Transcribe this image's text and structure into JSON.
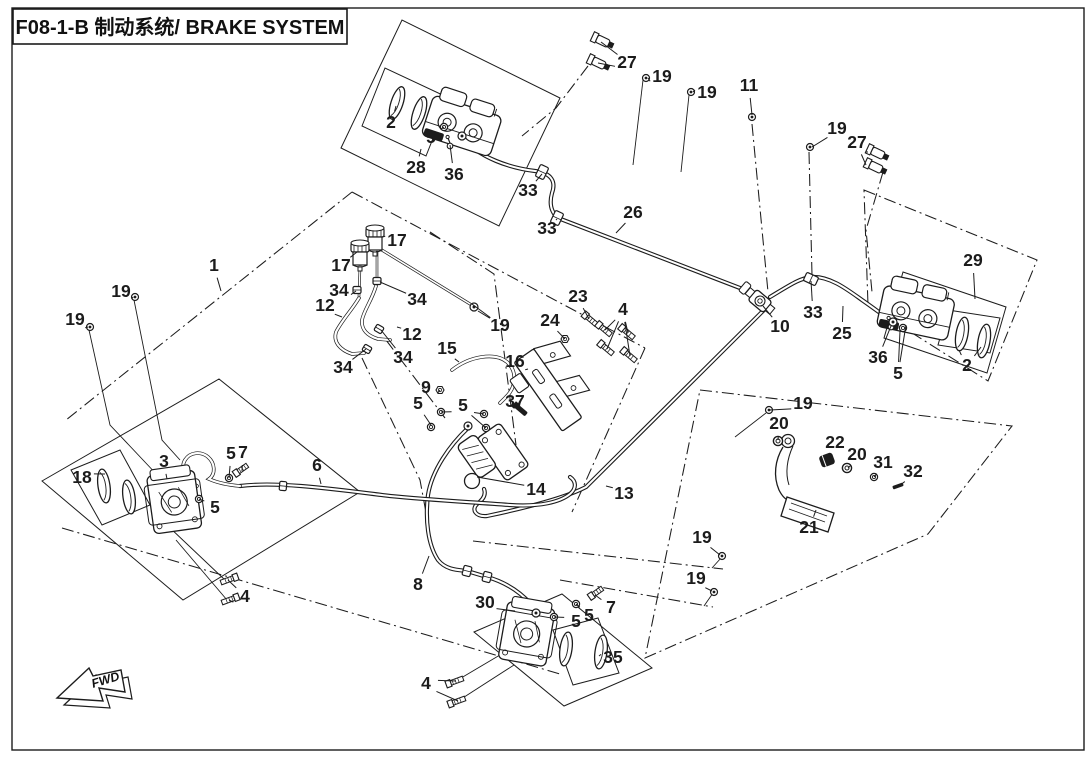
{
  "title": {
    "full": "F08-1-B 制动系统/ BRAKE SYSTEM"
  },
  "direction_arrow": {
    "label": "FWD"
  },
  "colors": {
    "ink": "#1c1c1c",
    "paper": "#ffffff"
  },
  "callouts": [
    {
      "n": "1",
      "x": 214,
      "y": 265,
      "targets": [
        [
          221,
          291
        ]
      ]
    },
    {
      "n": "2",
      "x": 391,
      "y": 122,
      "targets": [
        [
          396,
          106
        ]
      ]
    },
    {
      "n": "2",
      "x": 967,
      "y": 365,
      "targets": [
        [
          959,
          350
        ],
        [
          981,
          347
        ]
      ]
    },
    {
      "n": "3",
      "x": 164,
      "y": 461,
      "targets": [
        [
          167,
          479
        ]
      ]
    },
    {
      "n": "4",
      "x": 623,
      "y": 309,
      "targets": [
        [
          605,
          330
        ],
        [
          628,
          333
        ],
        [
          607,
          349
        ],
        [
          630,
          356
        ]
      ]
    },
    {
      "n": "4",
      "x": 245,
      "y": 596,
      "targets": [
        [
          228,
          580
        ],
        [
          229,
          600
        ]
      ]
    },
    {
      "n": "4",
      "x": 426,
      "y": 683,
      "targets": [
        [
          456,
          681
        ],
        [
          458,
          701
        ]
      ]
    },
    {
      "n": "5",
      "x": 431,
      "y": 137,
      "targets": [
        [
          444,
          127
        ]
      ]
    },
    {
      "n": "5",
      "x": 898,
      "y": 373,
      "targets": [
        [
          900,
          331
        ],
        [
          906,
          325
        ]
      ]
    },
    {
      "n": "5",
      "x": 418,
      "y": 403,
      "targets": [
        [
          431,
          425
        ]
      ]
    },
    {
      "n": "5",
      "x": 463,
      "y": 405,
      "targets": [
        [
          441,
          412
        ],
        [
          484,
          414
        ],
        [
          486,
          428
        ]
      ]
    },
    {
      "n": "5",
      "x": 231,
      "y": 453,
      "targets": [
        [
          229,
          478
        ]
      ]
    },
    {
      "n": "5",
      "x": 215,
      "y": 507,
      "targets": [
        [
          199,
          499
        ]
      ]
    },
    {
      "n": "5",
      "x": 576,
      "y": 621,
      "targets": [
        [
          554,
          617
        ]
      ]
    },
    {
      "n": "5",
      "x": 589,
      "y": 615,
      "targets": [
        [
          576,
          604
        ]
      ]
    },
    {
      "n": "6",
      "x": 317,
      "y": 465,
      "targets": [
        [
          321,
          484
        ]
      ]
    },
    {
      "n": "7",
      "x": 243,
      "y": 452,
      "targets": [
        [
          242,
          471
        ]
      ]
    },
    {
      "n": "7",
      "x": 611,
      "y": 607,
      "targets": [
        [
          595,
          595
        ]
      ]
    },
    {
      "n": "8",
      "x": 418,
      "y": 584,
      "targets": [
        [
          429,
          556
        ]
      ]
    },
    {
      "n": "9",
      "x": 426,
      "y": 387,
      "targets": [
        [
          440,
          390
        ]
      ]
    },
    {
      "n": "10",
      "x": 780,
      "y": 326,
      "targets": [
        [
          763,
          306
        ]
      ]
    },
    {
      "n": "11",
      "x": 749,
      "y": 85,
      "targets": [
        [
          752,
          115
        ]
      ]
    },
    {
      "n": "12",
      "x": 325,
      "y": 305,
      "targets": [
        [
          342,
          317
        ]
      ]
    },
    {
      "n": "12",
      "x": 412,
      "y": 334,
      "targets": [
        [
          397,
          327
        ]
      ]
    },
    {
      "n": "13",
      "x": 624,
      "y": 493,
      "targets": [
        [
          606,
          486
        ]
      ]
    },
    {
      "n": "14",
      "x": 536,
      "y": 489,
      "targets": [
        [
          477,
          477
        ]
      ]
    },
    {
      "n": "15",
      "x": 447,
      "y": 348,
      "targets": [
        [
          459,
          362
        ]
      ]
    },
    {
      "n": "16",
      "x": 515,
      "y": 361,
      "targets": [
        [
          528,
          369
        ]
      ]
    },
    {
      "n": "17",
      "x": 397,
      "y": 240,
      "targets": [
        [
          382,
          237
        ]
      ]
    },
    {
      "n": "17",
      "x": 341,
      "y": 265,
      "targets": [
        [
          357,
          252
        ]
      ]
    },
    {
      "n": "18",
      "x": 82,
      "y": 477,
      "targets": [
        [
          105,
          474
        ]
      ]
    },
    {
      "n": "19",
      "x": 662,
      "y": 76,
      "targets": [
        [
          648,
          78
        ]
      ]
    },
    {
      "n": "19",
      "x": 707,
      "y": 92,
      "targets": [
        [
          693,
          92
        ]
      ]
    },
    {
      "n": "19",
      "x": 837,
      "y": 128,
      "targets": [
        [
          812,
          147
        ]
      ]
    },
    {
      "n": "19",
      "x": 121,
      "y": 291,
      "targets": [
        [
          133,
          297
        ]
      ]
    },
    {
      "n": "19",
      "x": 75,
      "y": 319,
      "targets": [
        [
          88,
          327
        ]
      ]
    },
    {
      "n": "19",
      "x": 500,
      "y": 325,
      "targets": [
        [
          472,
          304
        ],
        [
          478,
          311
        ]
      ]
    },
    {
      "n": "19",
      "x": 803,
      "y": 403,
      "targets": [
        [
          770,
          410
        ]
      ]
    },
    {
      "n": "19",
      "x": 702,
      "y": 537,
      "targets": [
        [
          720,
          555
        ]
      ]
    },
    {
      "n": "19",
      "x": 696,
      "y": 578,
      "targets": [
        [
          712,
          591
        ]
      ]
    },
    {
      "n": "20",
      "x": 779,
      "y": 423,
      "targets": [
        [
          778,
          440
        ]
      ]
    },
    {
      "n": "20",
      "x": 857,
      "y": 454,
      "targets": [
        [
          848,
          468
        ]
      ]
    },
    {
      "n": "21",
      "x": 809,
      "y": 527,
      "targets": [
        [
          816,
          510
        ]
      ]
    },
    {
      "n": "22",
      "x": 835,
      "y": 442,
      "targets": [
        [
          828,
          459
        ]
      ]
    },
    {
      "n": "23",
      "x": 578,
      "y": 296,
      "targets": [
        [
          589,
          319
        ]
      ]
    },
    {
      "n": "24",
      "x": 550,
      "y": 320,
      "targets": [
        [
          565,
          339
        ]
      ]
    },
    {
      "n": "25",
      "x": 842,
      "y": 333,
      "targets": [
        [
          843,
          306
        ]
      ]
    },
    {
      "n": "26",
      "x": 633,
      "y": 212,
      "targets": [
        [
          616,
          233
        ]
      ]
    },
    {
      "n": "27",
      "x": 627,
      "y": 62,
      "targets": [
        [
          601,
          42
        ],
        [
          598,
          63
        ]
      ]
    },
    {
      "n": "27",
      "x": 857,
      "y": 142,
      "targets": [
        [
          868,
          152
        ],
        [
          866,
          165
        ]
      ]
    },
    {
      "n": "28",
      "x": 416,
      "y": 167,
      "targets": [
        [
          421,
          149
        ]
      ]
    },
    {
      "n": "29",
      "x": 973,
      "y": 260,
      "targets": [
        [
          975,
          299
        ]
      ]
    },
    {
      "n": "30",
      "x": 485,
      "y": 602,
      "targets": [
        [
          515,
          611
        ]
      ]
    },
    {
      "n": "31",
      "x": 883,
      "y": 462,
      "targets": [
        [
          874,
          477
        ]
      ]
    },
    {
      "n": "32",
      "x": 913,
      "y": 471,
      "targets": [
        [
          899,
          486
        ]
      ]
    },
    {
      "n": "33",
      "x": 528,
      "y": 190,
      "targets": [
        [
          542,
          174
        ]
      ]
    },
    {
      "n": "33",
      "x": 547,
      "y": 228,
      "targets": [
        [
          557,
          219
        ]
      ]
    },
    {
      "n": "33",
      "x": 813,
      "y": 312,
      "targets": [
        [
          811,
          281
        ]
      ]
    },
    {
      "n": "34",
      "x": 339,
      "y": 290,
      "targets": [
        [
          356,
          291
        ]
      ]
    },
    {
      "n": "34",
      "x": 417,
      "y": 299,
      "targets": [
        [
          380,
          282
        ]
      ]
    },
    {
      "n": "34",
      "x": 403,
      "y": 357,
      "targets": [
        [
          381,
          330
        ]
      ]
    },
    {
      "n": "34",
      "x": 343,
      "y": 367,
      "targets": [
        [
          366,
          349
        ]
      ]
    },
    {
      "n": "35",
      "x": 613,
      "y": 657,
      "targets": [
        [
          599,
          656
        ]
      ]
    },
    {
      "n": "36",
      "x": 454,
      "y": 174,
      "targets": [
        [
          450,
          145
        ]
      ]
    },
    {
      "n": "36",
      "x": 878,
      "y": 357,
      "targets": [
        [
          891,
          326
        ]
      ]
    },
    {
      "n": "37",
      "x": 515,
      "y": 401,
      "targets": [
        [
          521,
          410
        ]
      ]
    }
  ]
}
